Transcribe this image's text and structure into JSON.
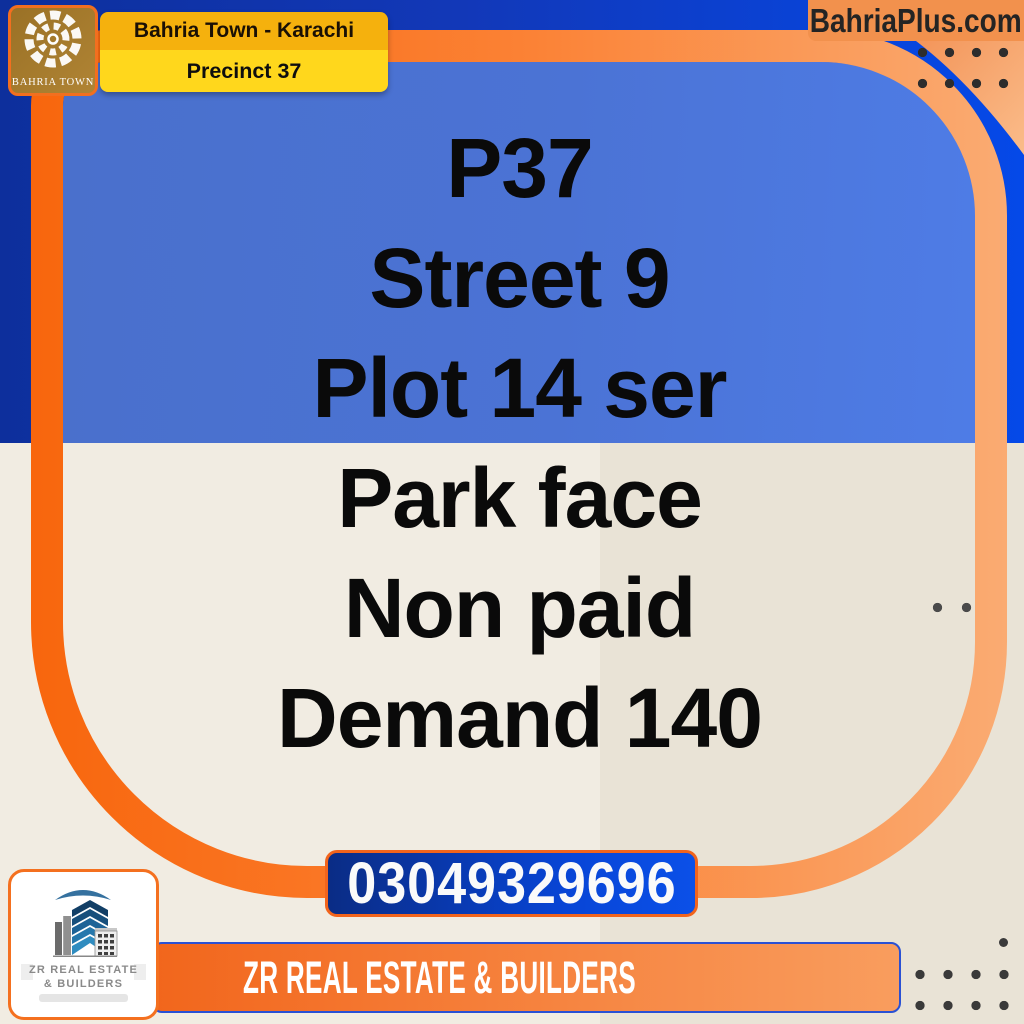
{
  "header": {
    "logo_caption": "BAHRIA TOWN",
    "banner_title": "Bahria Town - Karachi",
    "banner_subtitle": "Precinct 37",
    "website": "BahriaPlus.com"
  },
  "listing": {
    "lines": [
      "P37",
      "Street 9",
      "Plot 14 ser",
      "Park face",
      "Non paid",
      "Demand 140"
    ]
  },
  "footer": {
    "phone": "03049329696",
    "agency_banner": "ZR REAL ESTATE & BUILDERS",
    "agency_logo_line1": "ZR REAL ESTATE",
    "agency_logo_line2": "& BUILDERS"
  },
  "colors": {
    "frame_orange": "#F8690F",
    "navy": "#0D2F9C",
    "bright_blue": "#0549E8",
    "panel_blue": "#4A70CC",
    "cream_left": "#F1ECE2",
    "cream_right": "#E9E3D6",
    "banner_gold": "#F5B10D",
    "banner_yellow": "#FFD71C",
    "phone_button_blue": "#0845D6",
    "site_box_orange": "#F2914D"
  }
}
